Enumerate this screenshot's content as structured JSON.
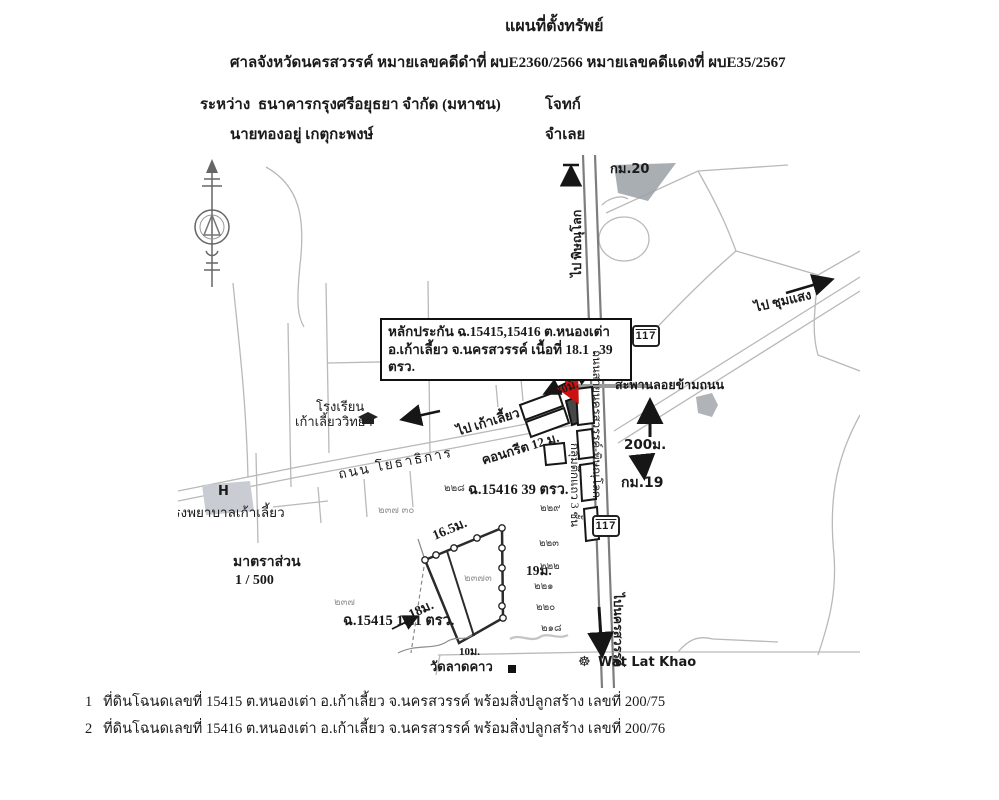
{
  "header": {
    "title": "แผนที่ตั้งทรัพย์",
    "court_line": "ศาลจังหวัดนครสวรรค์  หมายเลขคดีดำที่ ผบE2360/2566   หมายเลขคดีแดงที่ ผบE35/2567",
    "between_label": "ระหว่าง",
    "plaintiff": "ธนาคารกรุงศรีอยุธยา จำกัด (มหาชน)",
    "plaintiff_role": "โจทก์",
    "defendant": "นายทองอยู่ เกตุกะพงษ์",
    "defendant_role": "จำเลย"
  },
  "map": {
    "annotation_lines": [
      "หลักประกัน ฉ.15415,15416 ต.หนองเต่า",
      "อ.เก้าเลี้ยว จ.นครสวรรค์ เนื้อที่ 18.1 , 39",
      "ตรว."
    ],
    "labels": {
      "km20": "กม.20",
      "km19": "กม.19",
      "route117": "117",
      "to_phitsanulok": "ไป พิษณุโลก",
      "to_chumsaeng": "ไป ชุมแสง",
      "to_kaoliao": "ไป เก้าเลี้ยว",
      "to_nakhonsawan": "ไปนครสวรรค์",
      "highway_name": "ถนนสายนครสวรรค์-พิษณุโลก",
      "overpass": "สะพานลอยข้ามถนน",
      "dist200": "200ม.",
      "dist30": "30ม.",
      "concrete": "คอนกรีต 12 ม.",
      "road_yothathikan": "ถนน โยธาธิการ",
      "school_line1": "โรงเรียน",
      "school_line2": "เก้าเลี้ยววิทยา",
      "hospital_h": "H",
      "hospital": "โรงพยาบาลเก้าเลี้ยว",
      "scale_label": "มาตราส่วน",
      "scale_value": "1 / 500",
      "shophouses": "กลุ่มตึกแถว 3 ชั้น",
      "deed_15416": "ฉ.15416 39 ตรว.",
      "deed_15415": "ฉ.15415 18.1 ตรว.",
      "dim_16_5": "16.5ม.",
      "dim_19": "19ม.",
      "dim_18": "18ม.",
      "dim_10": "10ม.",
      "wat_thai": "วัดลาดคาว",
      "wat_eng": "Wat Lat Khao"
    },
    "icons": {
      "wat_marker": "☸"
    },
    "parcel_numbers": [
      "๒๒๘",
      "๒๒๙",
      "๒๒๓",
      "๒๒๒",
      "๒๒๑",
      "๒๒๐",
      "๒๑๘",
      "๒๓๗ ๓๐",
      "๒๓๗",
      "๒๓๗๓"
    ],
    "colors": {
      "arrow_red": "#cc1111",
      "road_gray": "#7d7d7d",
      "area_gray": "#9aa0a6"
    }
  },
  "footer": {
    "items": [
      {
        "num": "1",
        "text": "ที่ดินโฉนดเลขที่  15415 ต.หนองเต่า อ.เก้าเลี้ยว จ.นครสวรรค์ พร้อมสิ่งปลูกสร้าง  เลขที่ 200/75"
      },
      {
        "num": "2",
        "text": "ที่ดินโฉนดเลขที่  15416 ต.หนองเต่า อ.เก้าเลี้ยว จ.นครสวรรค์ พร้อมสิ่งปลูกสร้าง เลขที่ 200/76"
      }
    ]
  }
}
